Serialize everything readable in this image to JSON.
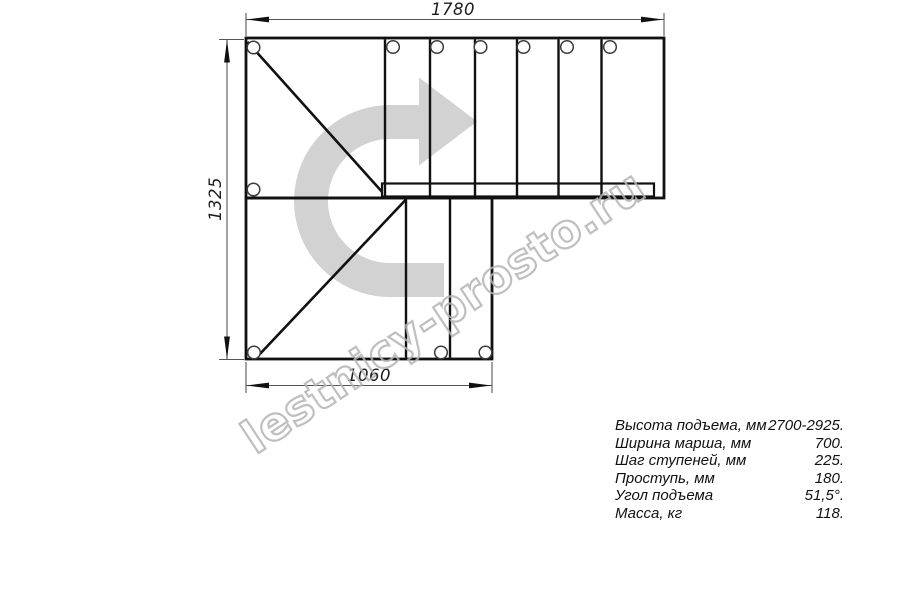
{
  "page": {
    "type": "staircase-plan-drawing",
    "background": "#ffffff"
  },
  "dimensions": {
    "top_width_mm": "1780",
    "left_height_mm": "1325",
    "bottom_width_mm": "1060"
  },
  "watermark": {
    "text": "lestnicy-prosto.ru",
    "stroke_color": "#b4b4b4",
    "angle_deg": -33.5
  },
  "icons": {
    "direction_arrow": "u-turn-right-arrow",
    "hole_marker": "circle"
  },
  "colors": {
    "outline": "#111111",
    "dim_line": "#555555",
    "arrow_fill": "#d2d2d2",
    "watermark_stroke": "#b4b4b4",
    "text": "#111111"
  },
  "specs": {
    "rows": [
      {
        "label": "Высота подъема, мм",
        "value": "2700-2925."
      },
      {
        "label": "Ширина марша, мм",
        "value": "700."
      },
      {
        "label": "Шаг ступеней, мм",
        "value": "225."
      },
      {
        "label": "Проступь, мм",
        "value": "180."
      },
      {
        "label": "Угол подъема",
        "value": "51,5°."
      },
      {
        "label": "Масса, кг",
        "value": "118."
      }
    ]
  }
}
